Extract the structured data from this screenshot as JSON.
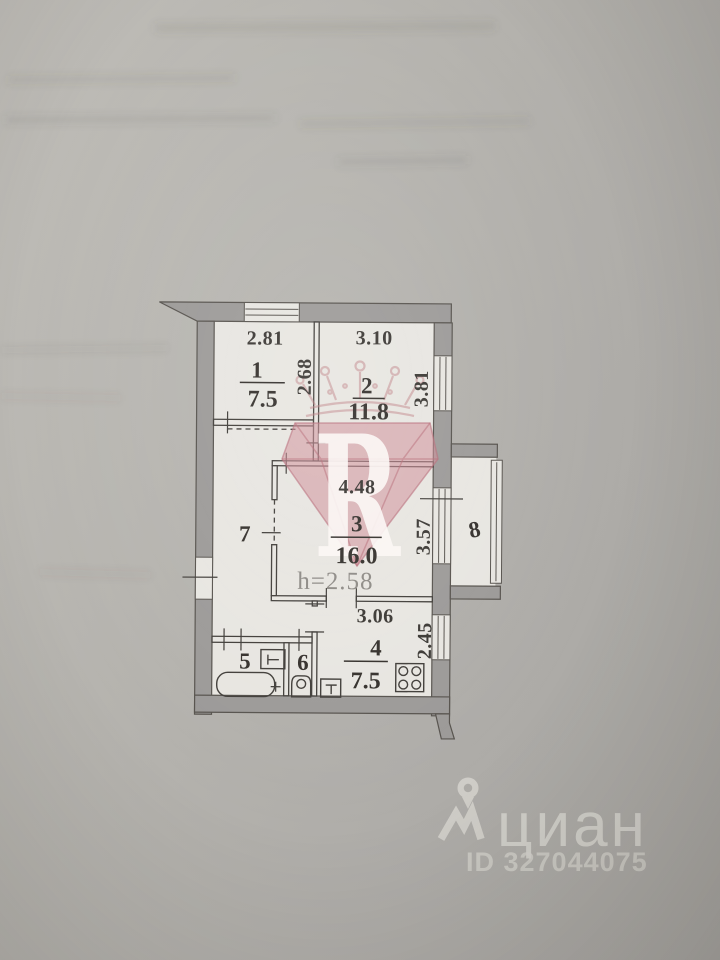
{
  "plan": {
    "rooms": [
      {
        "number": "1",
        "width": "2.81",
        "depth": "2.68",
        "area": "7.5"
      },
      {
        "number": "2",
        "width": "3.10",
        "depth": "3.81",
        "area": "11.8"
      },
      {
        "number": "3",
        "width": "4.48",
        "depth": "3.57",
        "area": "16.0",
        "ceiling_height": "h=2.58"
      },
      {
        "number": "4",
        "width": "3.06",
        "depth": "2.45",
        "area": "7.5"
      },
      {
        "number": "5"
      },
      {
        "number": "6"
      },
      {
        "number": "7"
      },
      {
        "number": "8"
      }
    ]
  },
  "watermark": {
    "letter": "R"
  },
  "branding": {
    "logo_text": "циан",
    "listing_id": "ID 327044075"
  },
  "colors": {
    "paper_background": "#b3b1ac",
    "plan_paper": "#e8e6e1",
    "wall_fill": "#9c9a98",
    "line": "#403d39",
    "watermark_pink": "#cd8d97",
    "logo_light": "#d8d6d0"
  }
}
